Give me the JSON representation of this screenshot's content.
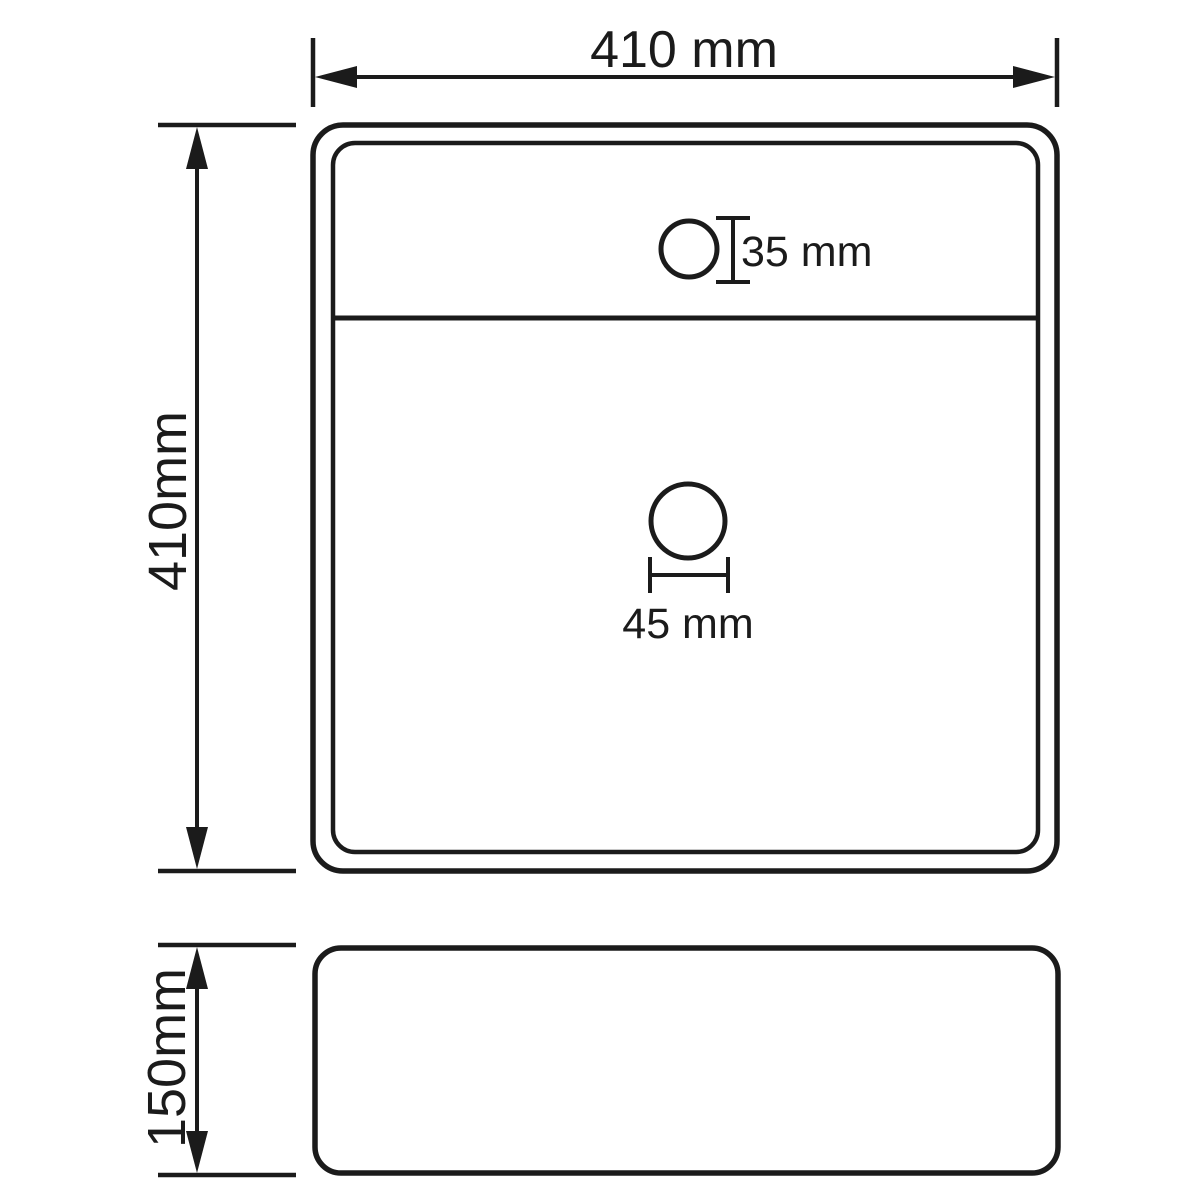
{
  "drawing": {
    "background_color": "#ffffff",
    "line_color": "#1b1b1b",
    "top_view": {
      "width_label": "410 mm",
      "height_label": "410mm",
      "faucet_hole_label": "35 mm",
      "drain_hole_label": "45 mm"
    },
    "side_view": {
      "height_label": "150mm"
    }
  }
}
